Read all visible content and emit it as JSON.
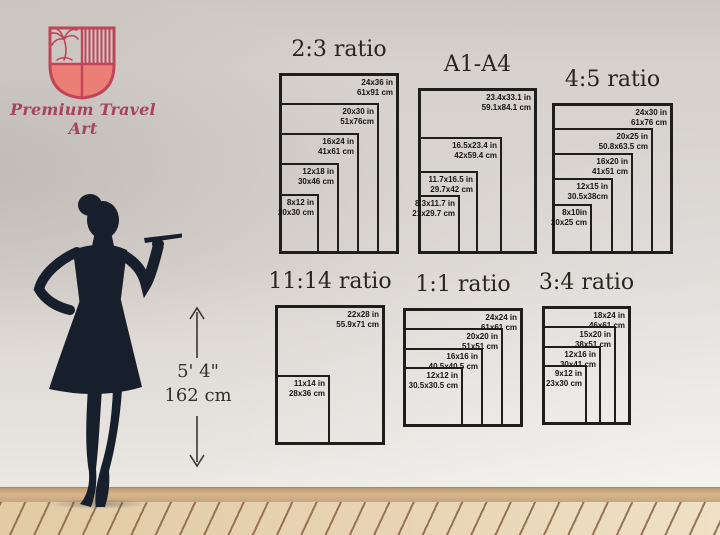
{
  "brand": {
    "name": "Premium Travel Art"
  },
  "logo": {
    "icon": "palm-tree-shield",
    "outline_color": "#c14459",
    "fill_color": "#ec7f75"
  },
  "model": {
    "figure": "woman-silhouette-holding-tray",
    "height_imperial": "5' 4\"",
    "height_metric": "162 cm"
  },
  "colors": {
    "wall": "#d8d3cf",
    "baseboard": "#d6b68e",
    "floor": "#e8d4b3",
    "floor_line": "#8c6a49",
    "chart_line": "#1e1e1e",
    "silhouette": "#161f2b",
    "brand_crimson": "#c14459",
    "brand_salmon": "#ec7f75"
  },
  "charts": [
    {
      "title": "2:3 ratio",
      "sizes": [
        {
          "label_in": "24x36 in",
          "label_cm": "61x91 cm",
          "w": 24,
          "h": 36
        },
        {
          "label_in": "20x30 in",
          "label_cm": "51x76cm",
          "w": 20,
          "h": 30
        },
        {
          "label_in": "16x24 in",
          "label_cm": "41x61 cm",
          "w": 16,
          "h": 24
        },
        {
          "label_in": "12x18 in",
          "label_cm": "30x46 cm",
          "w": 12,
          "h": 18
        },
        {
          "label_in": "8x12 in",
          "label_cm": "20x30 cm",
          "w": 8,
          "h": 12
        }
      ]
    },
    {
      "title": "A1-A4",
      "sizes": [
        {
          "label_in": "23.4x33.1 in",
          "label_cm": "59.1x84.1 cm",
          "w": 23.4,
          "h": 33.1
        },
        {
          "label_in": "16.5x23.4 in",
          "label_cm": "42x59.4 cm",
          "w": 16.5,
          "h": 23.4
        },
        {
          "label_in": "11.7x16.5 in",
          "label_cm": "29.7x42 cm",
          "w": 11.7,
          "h": 16.5
        },
        {
          "label_in": "8.3x11.7 in",
          "label_cm": "21x29.7 cm",
          "w": 8.3,
          "h": 11.7
        }
      ]
    },
    {
      "title": "4:5 ratio",
      "sizes": [
        {
          "label_in": "24x30 in",
          "label_cm": "61x76 cm",
          "w": 24,
          "h": 30
        },
        {
          "label_in": "20x25 in",
          "label_cm": "50.8x63.5 cm",
          "w": 20,
          "h": 25
        },
        {
          "label_in": "16x20 in",
          "label_cm": "41x51 cm",
          "w": 16,
          "h": 20
        },
        {
          "label_in": "12x15 in",
          "label_cm": "30.5x38cm",
          "w": 12,
          "h": 15
        },
        {
          "label_in": "8x10in",
          "label_cm": "20x25 cm",
          "w": 8,
          "h": 10
        }
      ]
    },
    {
      "title": "11:14 ratio",
      "sizes": [
        {
          "label_in": "22x28 in",
          "label_cm": "55.9x71 cm",
          "w": 22,
          "h": 28
        },
        {
          "label_in": "11x14 in",
          "label_cm": "28x36 cm",
          "w": 11,
          "h": 14
        }
      ]
    },
    {
      "title": "1:1 ratio",
      "sizes": [
        {
          "label_in": "24x24 in",
          "label_cm": "61x61 cm",
          "w": 24,
          "h": 24
        },
        {
          "label_in": "20x20 in",
          "label_cm": "51x51 cm",
          "w": 20,
          "h": 20
        },
        {
          "label_in": "16x16 in",
          "label_cm": "40.5x40.5 cm",
          "w": 16,
          "h": 16
        },
        {
          "label_in": "12x12 in",
          "label_cm": "30.5x30.5 cm",
          "w": 12,
          "h": 12
        }
      ]
    },
    {
      "title": "3:4 ratio",
      "sizes": [
        {
          "label_in": "18x24 in",
          "label_cm": "46x61 cm",
          "w": 18,
          "h": 24
        },
        {
          "label_in": "15x20 in",
          "label_cm": "38x51 cm",
          "w": 15,
          "h": 20
        },
        {
          "label_in": "12x16 in",
          "label_cm": "30x41 cm",
          "w": 12,
          "h": 16
        },
        {
          "label_in": "9x12 in",
          "label_cm": "23x30 cm",
          "w": 9,
          "h": 12
        }
      ]
    }
  ]
}
